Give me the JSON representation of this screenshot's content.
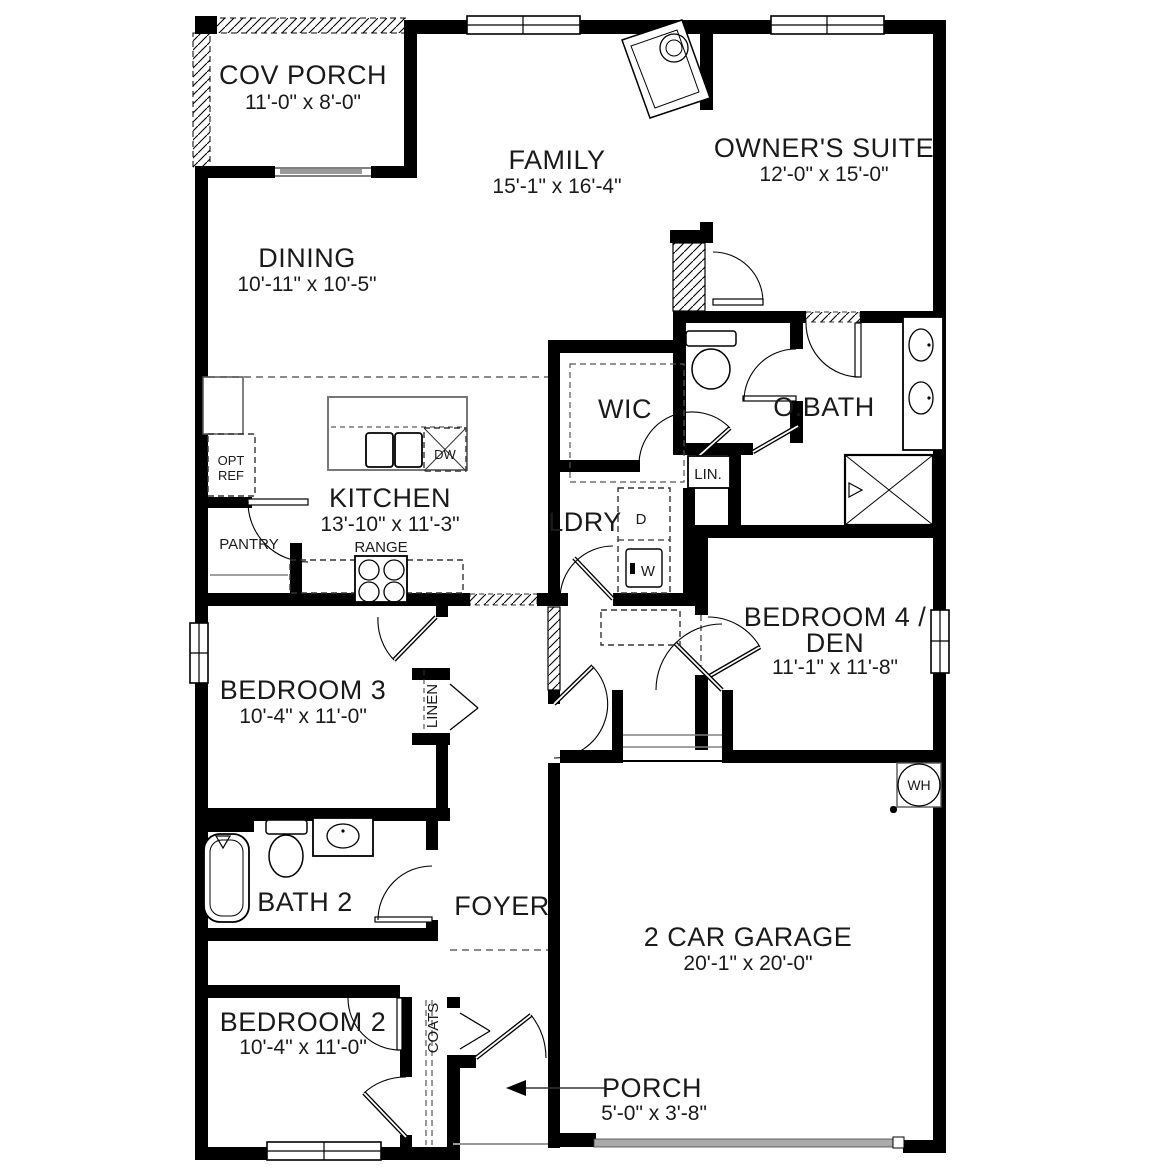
{
  "plan_title": "floor-plan",
  "rooms": {
    "cov_porch": {
      "name": "COV PORCH",
      "dims": "11'-0\" x 8'-0\""
    },
    "family": {
      "name": "FAMILY",
      "dims": "15'-1\" x 16'-4\""
    },
    "owners_suite": {
      "name": "OWNER'S SUITE",
      "dims": "12'-0\" x 15'-0\""
    },
    "dining": {
      "name": "DINING",
      "dims": "10'-11\" x 10'-5\""
    },
    "wic": {
      "name": "WIC"
    },
    "obath": {
      "name": "O.BATH"
    },
    "kitchen": {
      "name": "KITCHEN",
      "dims": "13'-10\" x 11'-3\""
    },
    "ldry": {
      "name": "LDRY"
    },
    "bedroom4": {
      "name_line1": "BEDROOM 4 /",
      "name_line2": "DEN",
      "dims": "11'-1\" x 11'-8\""
    },
    "bedroom3": {
      "name": "BEDROOM 3",
      "dims": "10'-4\" x 11'-0\""
    },
    "bath2": {
      "name": "BATH 2"
    },
    "foyer": {
      "name": "FOYER"
    },
    "garage": {
      "name": "2 CAR GARAGE",
      "dims": "20'-1\" x 20'-0\""
    },
    "bedroom2": {
      "name": "BEDROOM 2",
      "dims": "10'-4\" x 11'-0\""
    },
    "porch": {
      "name": "PORCH",
      "dims": "5'-0\" x 3'-8\""
    }
  },
  "fixtures": {
    "opt_ref_line1": "OPT",
    "opt_ref_line2": "REF",
    "pantry": "PANTRY",
    "range": "RANGE",
    "dishwasher": "DW",
    "dryer": "D",
    "washer": "W",
    "linen_small": "LIN.",
    "linen": "LINEN",
    "coats": "COATS",
    "water_heater": "WH"
  },
  "colors": {
    "wall": "#000000",
    "text": "#1a1a1a",
    "gray": "#808080"
  }
}
